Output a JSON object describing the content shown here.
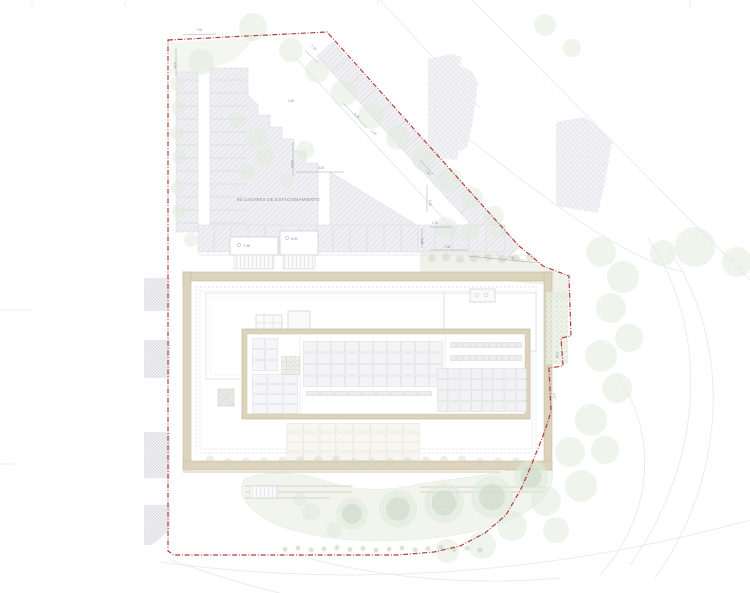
{
  "drawing": {
    "type": "architectural-site-plan",
    "parking_label": "60 LUGARES DE ESTACIONAMIENTO",
    "levels": {
      "ramp_a": "7.98",
      "ramp_b": "8.01"
    }
  },
  "colors": {
    "boundary_red": "#b43c3c",
    "wall_beige": "#dbd3bc",
    "wall_edge": "#c7bd9f",
    "hatch_line": "#dadae1",
    "hatch_bg": "#f0f0f3",
    "tree_green": "#e0e9dc",
    "tree_ring": "#cfdccb",
    "bush_green": "#cdd6c4",
    "garden": "#eef2e8",
    "dim_text": "#8f8f93",
    "faint_line": "#ececec"
  },
  "dimensions": [
    {
      "text": "7.30",
      "x": 196,
      "y": 31,
      "rot": -2
    },
    {
      "text": "3.23",
      "x": 174,
      "y": 62,
      "rot": 90
    },
    {
      "text": "1.10",
      "x": 311,
      "y": 46,
      "rot": 47
    },
    {
      "text": "5.40",
      "x": 354,
      "y": 114,
      "rot": 47
    },
    {
      "text": "2.40",
      "x": 371,
      "y": 131,
      "rot": 47
    },
    {
      "text": "1.50",
      "x": 288,
      "y": 102,
      "rot": 0
    },
    {
      "text": "10.00",
      "x": 291,
      "y": 160,
      "rot": 90
    },
    {
      "text": "8.00",
      "x": 318,
      "y": 169,
      "rot": 0
    },
    {
      "text": "2.30",
      "x": 425,
      "y": 171,
      "rot": 47
    },
    {
      "text": "1.10",
      "x": 429,
      "y": 200,
      "rot": 90
    },
    {
      "text": "1.10",
      "x": 432,
      "y": 224,
      "rot": 0
    },
    {
      "text": "7.98",
      "x": 444,
      "y": 248,
      "rot": 0
    },
    {
      "text": "7.06",
      "x": 508,
      "y": 258,
      "rot": 14
    },
    {
      "text": "3.18",
      "x": 421,
      "y": 238,
      "rot": 90
    },
    {
      "text": "1.10",
      "x": 556,
      "y": 352,
      "rot": 90
    },
    {
      "text": "2.57",
      "x": 553,
      "y": 393,
      "rot": 90
    }
  ],
  "trees": {
    "plain": [
      [
        201,
        62,
        13
      ],
      [
        253,
        27,
        14
      ],
      [
        291,
        50,
        12
      ],
      [
        317,
        71,
        12
      ],
      [
        344,
        93,
        13
      ],
      [
        371,
        116,
        13
      ],
      [
        398,
        138,
        12
      ],
      [
        424,
        159,
        12
      ],
      [
        450,
        180,
        12
      ],
      [
        472,
        198,
        11
      ],
      [
        494,
        216,
        10
      ],
      [
        237,
        120,
        8
      ],
      [
        257,
        138,
        10
      ],
      [
        265,
        157,
        9
      ],
      [
        247,
        172,
        8
      ],
      [
        305,
        150,
        9
      ],
      [
        287,
        180,
        7
      ],
      [
        177,
        84,
        7
      ],
      [
        178,
        108,
        7
      ],
      [
        177,
        133,
        7
      ],
      [
        179,
        157,
        7
      ],
      [
        178,
        188,
        7
      ],
      [
        179,
        211,
        7
      ],
      [
        446,
        228,
        11
      ],
      [
        470,
        232,
        9
      ],
      [
        498,
        230,
        8
      ],
      [
        545,
        25,
        11
      ],
      [
        572,
        48,
        9
      ],
      [
        663,
        253,
        13
      ],
      [
        695,
        247,
        20
      ],
      [
        737,
        262,
        15
      ],
      [
        601,
        252,
        15
      ],
      [
        623,
        277,
        16
      ],
      [
        611,
        308,
        15
      ],
      [
        629,
        338,
        14
      ],
      [
        601,
        356,
        16
      ],
      [
        617,
        388,
        15
      ],
      [
        591,
        420,
        16
      ],
      [
        605,
        450,
        14
      ],
      [
        570,
        452,
        15
      ],
      [
        581,
        486,
        16
      ],
      [
        546,
        501,
        15
      ],
      [
        556,
        530,
        13
      ],
      [
        512,
        526,
        15
      ],
      [
        482,
        545,
        14
      ],
      [
        447,
        551,
        12
      ],
      [
        311,
        512,
        9
      ],
      [
        300,
        499,
        7
      ],
      [
        334,
        530,
        8
      ],
      [
        191,
        240,
        7
      ]
    ],
    "ring": [
      [
        352,
        514,
        16
      ],
      [
        398,
        509,
        19
      ],
      [
        444,
        503,
        20
      ],
      [
        492,
        497,
        21
      ],
      [
        531,
        477,
        17
      ]
    ]
  },
  "bush_rows": [
    {
      "y": 258,
      "x0": 432,
      "x1": 542,
      "step": 14,
      "r": 4,
      "op": 0.5
    },
    {
      "y": 461,
      "x0": 210,
      "x1": 530,
      "step": 18,
      "r": 4,
      "op": 0.4
    },
    {
      "y": 549,
      "x0": 285,
      "x1": 480,
      "step": 13,
      "r": 2.5,
      "op": 0.65
    }
  ]
}
